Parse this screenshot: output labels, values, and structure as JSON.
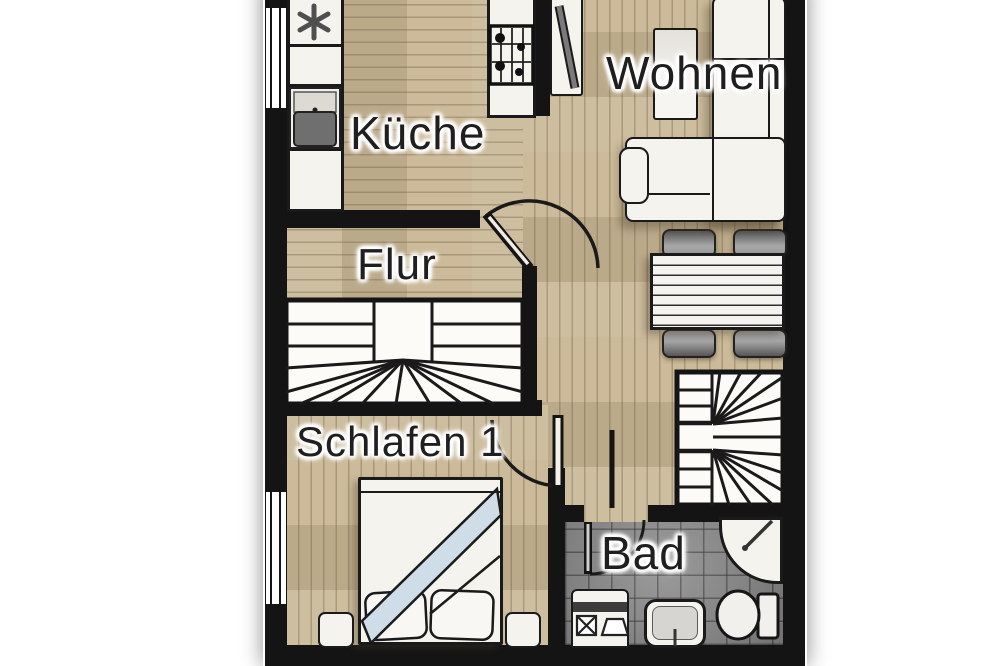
{
  "rooms": {
    "kitchen": {
      "label": "Küche"
    },
    "living": {
      "label": "Wohnen"
    },
    "hall": {
      "label": "Flur"
    },
    "bedroom": {
      "label": "Schlafen 1"
    },
    "bath": {
      "label": "Bad"
    }
  },
  "colors": {
    "wall": "#141414",
    "outline": "#1a1a1a",
    "wood_base": "#c9b795",
    "tile_base": "#8e8e8e",
    "furniture_fill": "#f5f3ed",
    "chair_fill": "#9e9e9e",
    "blanket_fill": "#cfdde9",
    "basin": "#6f6f6f",
    "label": "#1f1f1f",
    "page_bg": "#ffffff"
  }
}
